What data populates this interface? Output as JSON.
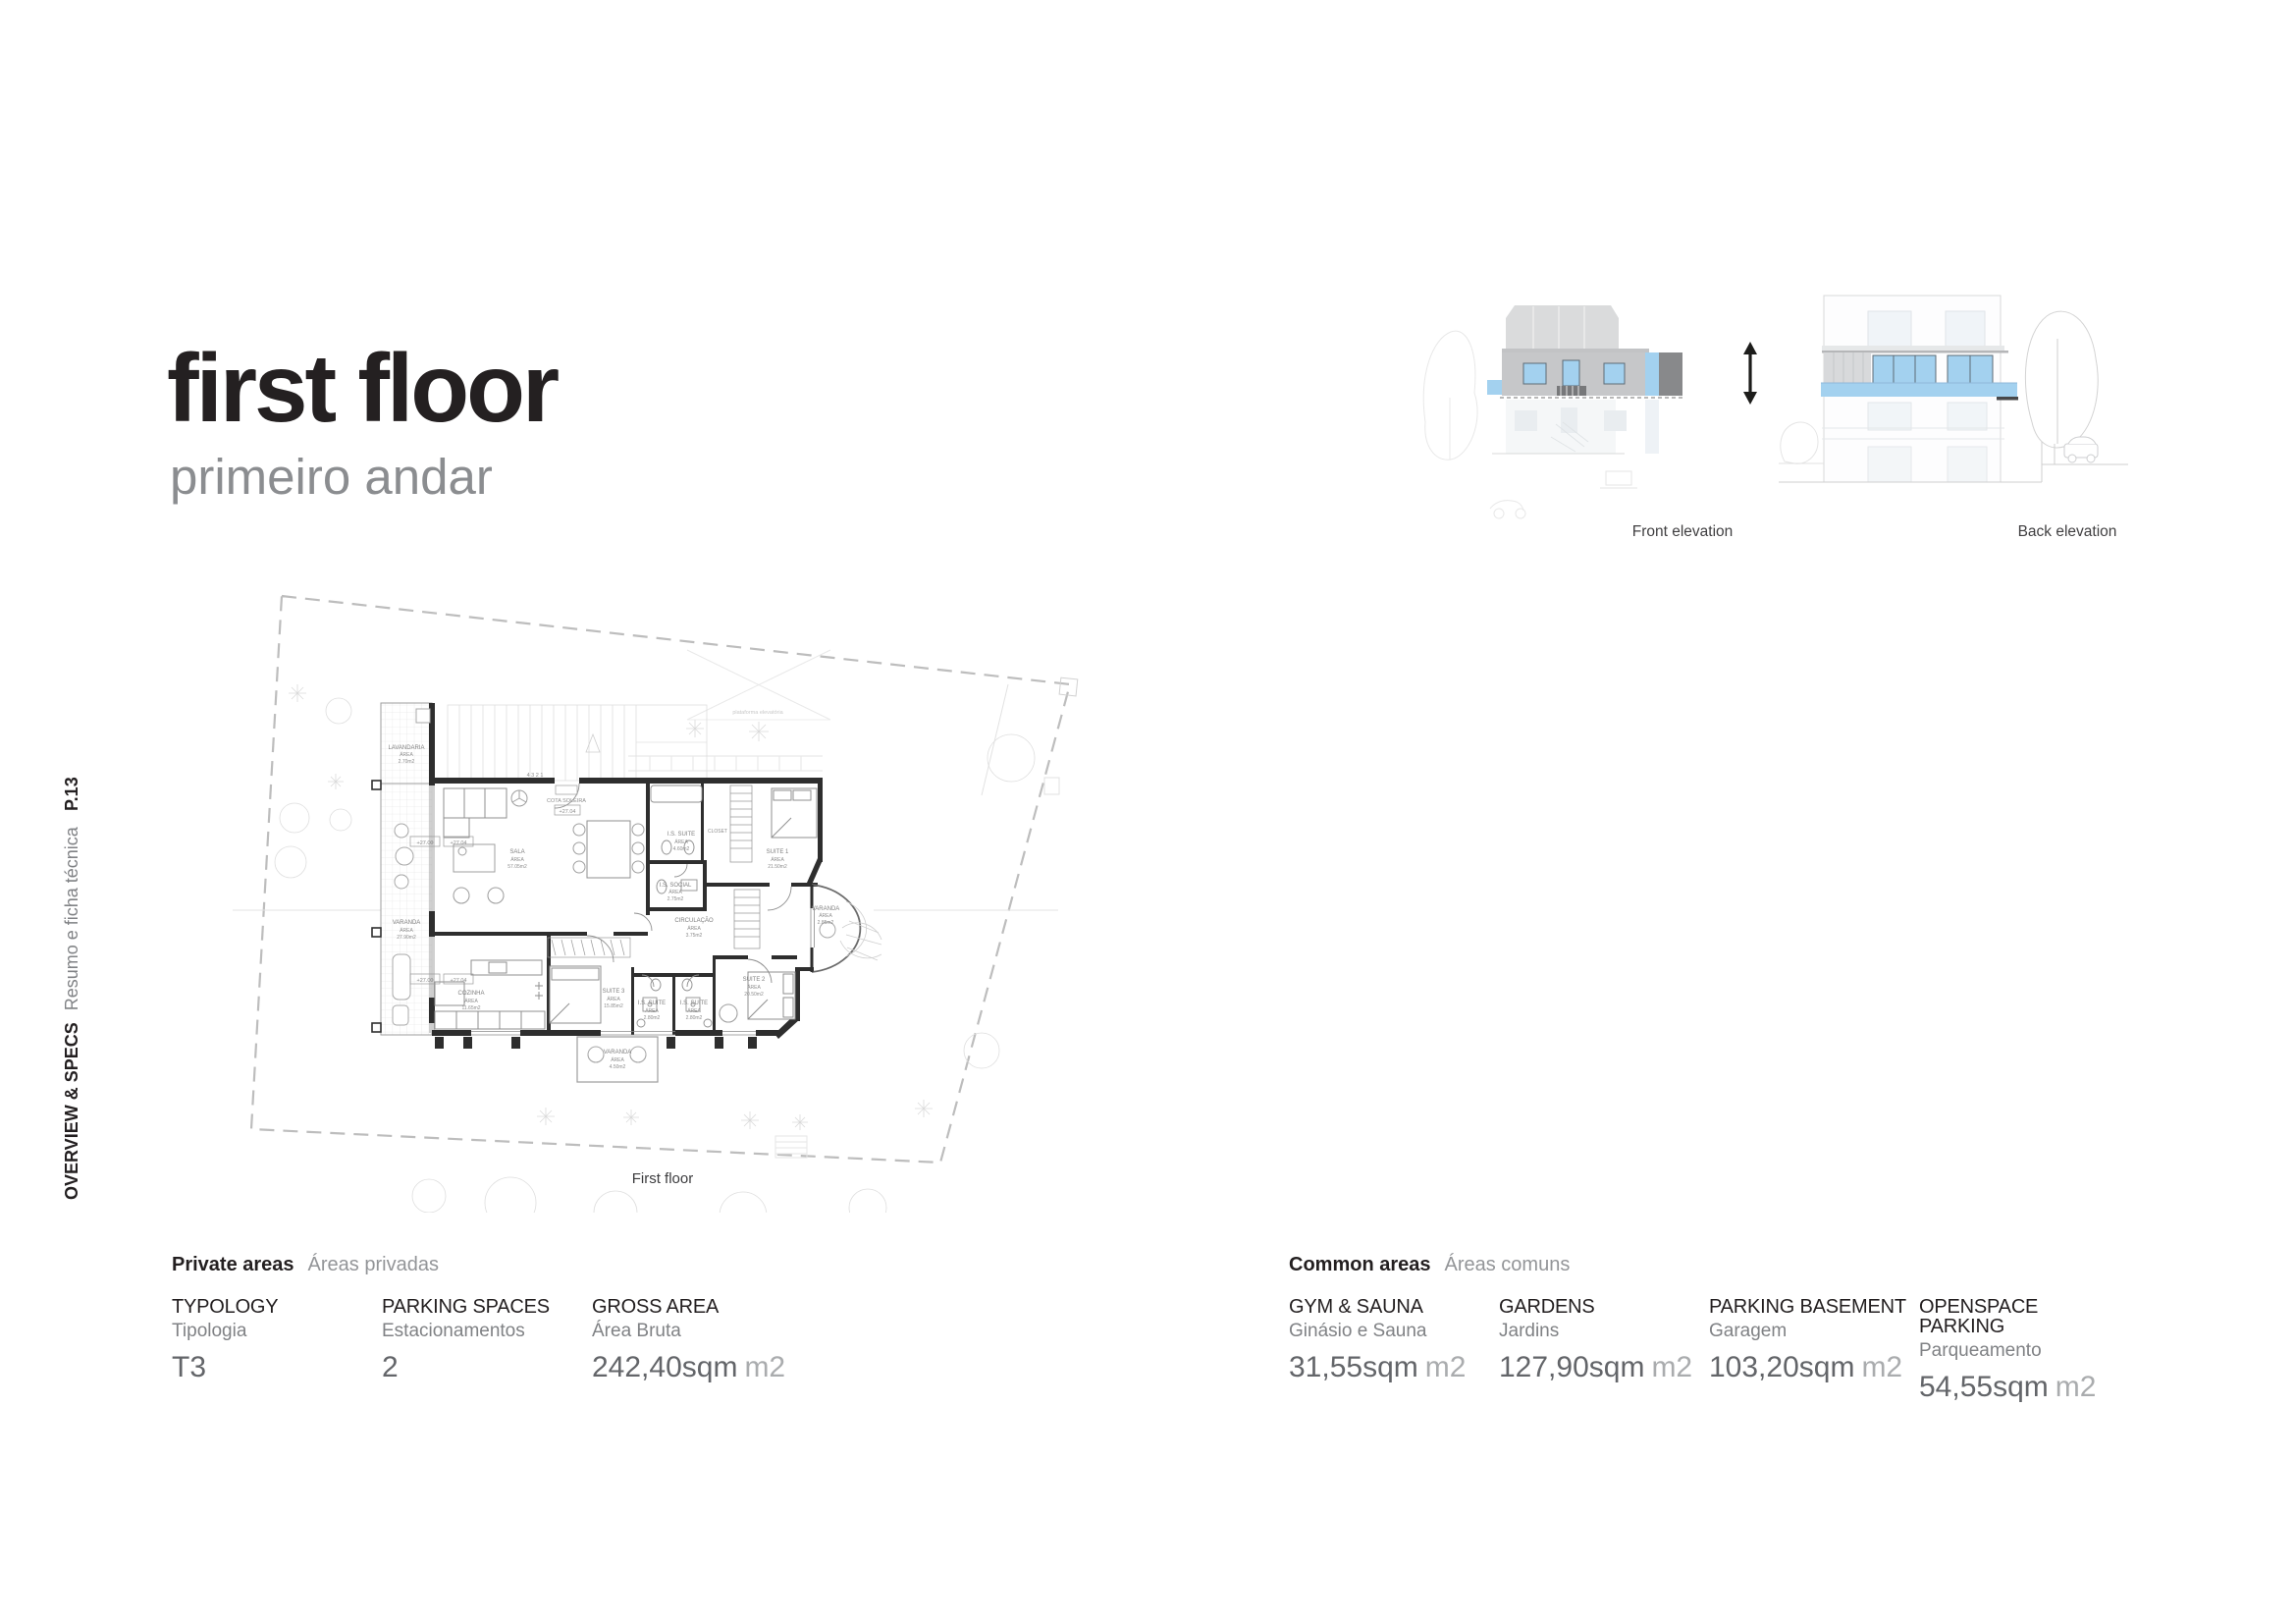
{
  "page": {
    "page_number": "P.13",
    "sidebar_title": "OVERVIEW & SPECS",
    "sidebar_subtitle": "Resumo e ficha técnica"
  },
  "header": {
    "title": "first floor",
    "subtitle": "primeiro andar"
  },
  "elevations": {
    "front_label": "Front elevation",
    "back_label": "Back elevation",
    "accent_blue": "#a3d1ef",
    "band_gray": "#c6c7c9",
    "dark_gray": "#88898b"
  },
  "plan": {
    "caption": "First floor",
    "area_word": "ÁREA",
    "annotations": {
      "cota_label": "COTA SOLEIRA",
      "cota_value": "+27.04",
      "level_a": "+27.00",
      "level_b": "+27.04",
      "platform_note": "plataforma elevatória",
      "stair_numbers": "4  3  2  1"
    },
    "rooms": [
      {
        "name": "LAVANDARIA",
        "area": "2.70m2"
      },
      {
        "name": "SALA",
        "area": "57.05m2"
      },
      {
        "name": "VARANDA",
        "area": "27.90m2"
      },
      {
        "name": "COZINHA",
        "area": "11.65m2"
      },
      {
        "name": "SUITE 3",
        "area": "15.85m2"
      },
      {
        "name": "I.S. SUITE",
        "area": "2.80m2"
      },
      {
        "name": "I.S. SUITE",
        "area": "2.80m2"
      },
      {
        "name": "SUITE 2",
        "area": "20.50m2"
      },
      {
        "name": "VARANDA",
        "area": "4.50m2"
      },
      {
        "name": "CIRCULAÇÃO",
        "area": "3.75m2"
      },
      {
        "name": "I.S. SOCIAL",
        "area": "2.75m2"
      },
      {
        "name": "I.S. SUITE",
        "area": "4.60m2"
      },
      {
        "name": "CLOSET",
        "area": ""
      },
      {
        "name": "SUITE 1",
        "area": "21.50m2"
      },
      {
        "name": "VARANDA",
        "area": "2.85m2"
      }
    ]
  },
  "private_areas": {
    "heading": "Private areas",
    "heading_pt": "Áreas privadas",
    "items": [
      {
        "label": "TYPOLOGY",
        "label_pt": "Tipologia",
        "value": "T3",
        "unit": ""
      },
      {
        "label": "PARKING SPACES",
        "label_pt": "Estacionamentos",
        "value": "2",
        "unit": ""
      },
      {
        "label": "GROSS AREA",
        "label_pt": "Área Bruta",
        "value": "242,40sqm",
        "unit": "m2"
      }
    ]
  },
  "common_areas": {
    "heading": "Common areas",
    "heading_pt": "Áreas comuns",
    "items": [
      {
        "label": "GYM & SAUNA",
        "label_pt": "Ginásio e Sauna",
        "value": "31,55sqm",
        "unit": "m2"
      },
      {
        "label": "GARDENS",
        "label_pt": "Jardins",
        "value": "127,90sqm",
        "unit": "m2"
      },
      {
        "label": "PARKING BASEMENT",
        "label_pt": "Garagem",
        "value": "103,20sqm",
        "unit": "m2"
      },
      {
        "label": "OPENSPACE PARKING",
        "label_pt": "Parqueamento",
        "value": "54,55sqm",
        "unit": "m2"
      }
    ]
  }
}
